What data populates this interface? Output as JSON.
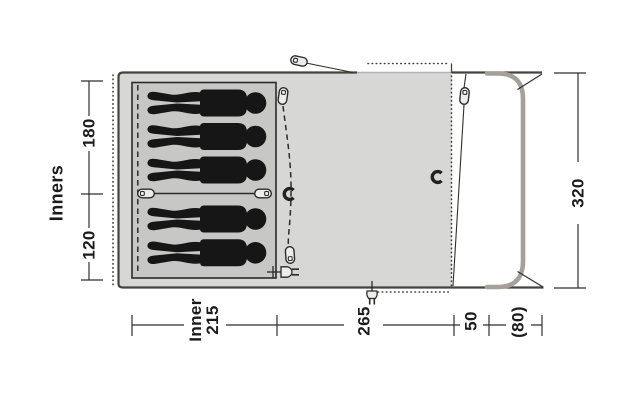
{
  "diagram_type": "tent-floorplan-top-view",
  "labels": {
    "inners_group": "Inners",
    "inner_depth_top": "180",
    "inner_depth_bottom": "120",
    "total_depth": "320",
    "inner_width_line1": "Inner",
    "inner_width_line2": "215",
    "living_width": "265",
    "front_width": "50",
    "canopy_width": "(80)"
  },
  "figures": {
    "top_compartment": 3,
    "bottom_compartment": 2
  },
  "icons": [
    "zip-pull",
    "lantern-hook",
    "power-socket",
    "guy-line"
  ],
  "colors": {
    "floor": "#d7d7d5",
    "inner_floor": "#c7c7c5",
    "outline": "#44443f",
    "inner_outline": "#2b2b28",
    "door": "#a6a09a",
    "figure": "#161616",
    "dim": "#2f2f2d",
    "icon_fill": "#ececea"
  }
}
